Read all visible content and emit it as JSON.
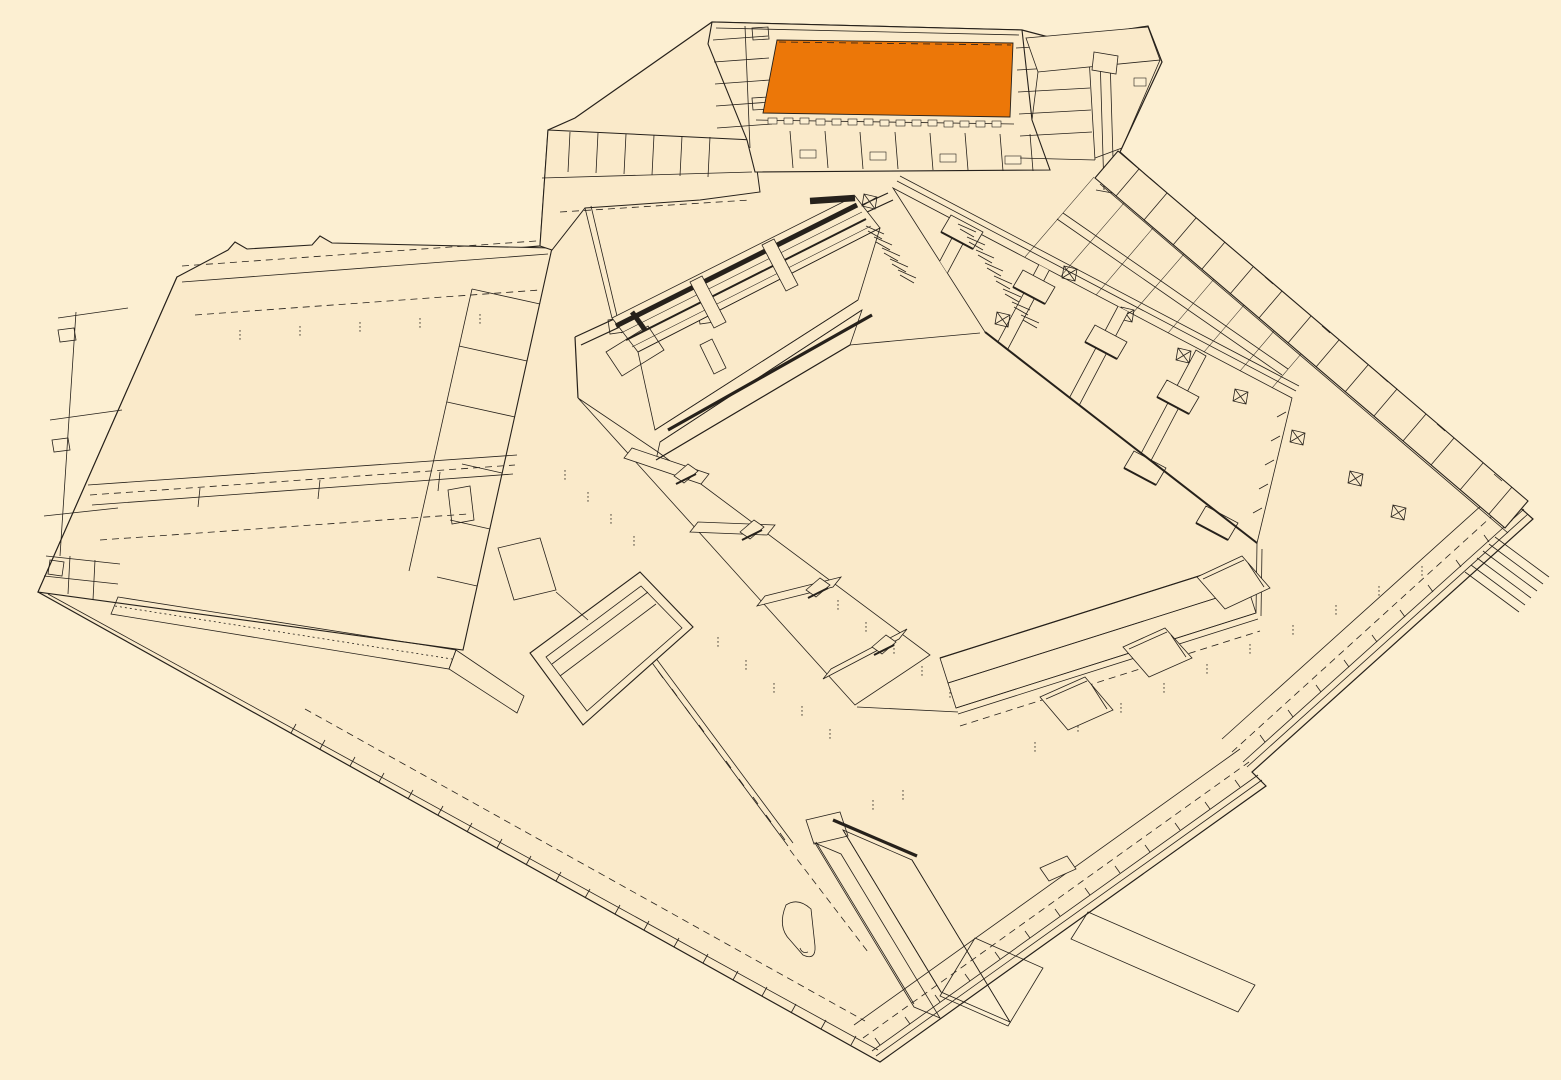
{
  "canvas": {
    "width": 1561,
    "height": 1080
  },
  "colors": {
    "background": "#FCEFD2",
    "paper": "#FAEACA",
    "ink": "#26211B",
    "highlight": "#EC7708"
  },
  "scene": {
    "type": "axonometric architectural line drawing",
    "subject": "arena and hall complex with surrounding plaza, one hall highlighted in orange",
    "regions": [
      {
        "id": "highlighted-hall",
        "label": "orange highlighted hall in north wing"
      },
      {
        "id": "top-building",
        "label": "north wing with small rooms and lockers"
      },
      {
        "id": "connector-wing",
        "label": "north-west connector rooms and terrace"
      },
      {
        "id": "left-hall-building",
        "label": "large west hall building with corridor and lattice facade"
      },
      {
        "id": "arena-bowl",
        "label": "central arena bowl with tiered stands"
      },
      {
        "id": "arena-floor",
        "label": "open arena floor"
      },
      {
        "id": "north-west-stand",
        "label": "north-west stand with heavy dark railings"
      },
      {
        "id": "west-stand",
        "label": "west stand with vomitories"
      },
      {
        "id": "east-stand",
        "label": "large east stand with vomitories and aisles"
      },
      {
        "id": "south-stand",
        "label": "south stand bands"
      },
      {
        "id": "north-east-room-band",
        "label": "band of rooms along north-east perimeter wall"
      },
      {
        "id": "roof-concourse",
        "label": "beamed concourse strip behind east stand"
      },
      {
        "id": "plaza",
        "label": "surrounding plaza slab with edge walkways and posts"
      },
      {
        "id": "south-stairs",
        "label": "broad interior stair flights on south plaza"
      },
      {
        "id": "exterior-stairs",
        "label": "exterior stair flights across south-east edge"
      },
      {
        "id": "kiosks",
        "label": "free-standing kiosks along bowl exterior"
      },
      {
        "id": "box-structure",
        "label": "small rectangular enclosure west of the bowl"
      },
      {
        "id": "mast",
        "label": "slender mast at north-east corner of north wing"
      }
    ]
  }
}
